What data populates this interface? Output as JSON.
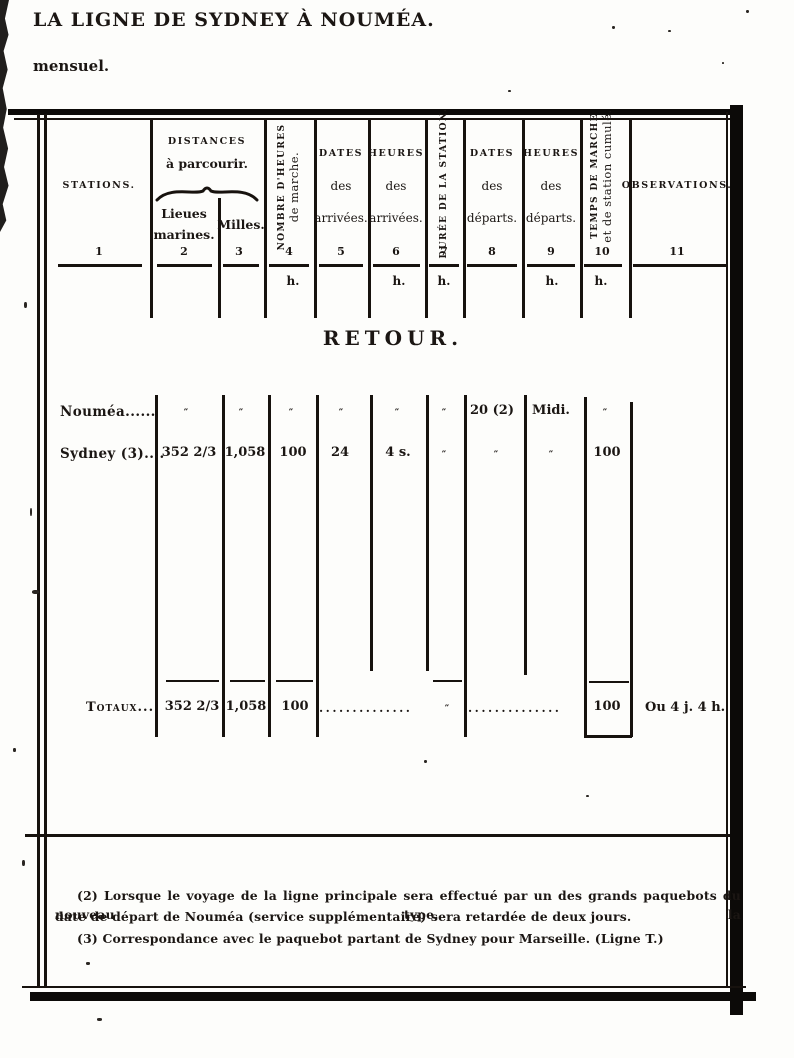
{
  "page": {
    "title": "LA LIGNE DE SYDNEY À NOUMÉA.",
    "subtitle": "mensuel."
  },
  "table": {
    "header": {
      "stations": {
        "label": "STATIONS.",
        "num": "1"
      },
      "distances_group": {
        "line1": "DISTANCES",
        "line2": "à parcourir."
      },
      "lieues": {
        "line1": "Lieues",
        "line2": "marines.",
        "num": "2"
      },
      "milles": {
        "label": "Milles.",
        "num": "3"
      },
      "heures_marche": {
        "line1": "NOMBRE D'HEURES",
        "line2": "de marche.",
        "num": "4",
        "unit": "h."
      },
      "dates_arrivees": {
        "line1": "DATES",
        "line2": "des",
        "line3": "arrivées.",
        "num": "5"
      },
      "heures_arrivees": {
        "line1": "HEURES",
        "line2": "des",
        "line3": "arrivées.",
        "num": "6",
        "unit": "h."
      },
      "duree_station": {
        "label": "DURÉE DE LA STATION.",
        "num": "7",
        "unit": "h."
      },
      "dates_departs": {
        "line1": "DATES",
        "line2": "des",
        "line3": "départs.",
        "num": "8"
      },
      "heures_departs": {
        "line1": "HEURES",
        "line2": "des",
        "line3": "départs.",
        "num": "9",
        "unit": "h."
      },
      "temps_marche": {
        "line1": "TEMPS DE MARCHE",
        "line2": "et de station cumulé.",
        "num": "10",
        "unit": "h."
      },
      "observations": {
        "label": "OBSERVATIONS.",
        "num": "11"
      }
    },
    "section_title": "RETOUR.",
    "rows": [
      {
        "station": "Nouméa......",
        "lieues": "″",
        "milles": "″",
        "heures_marche": "″",
        "dates_arr": "″",
        "heures_arr": "″",
        "duree": "″",
        "dates_dep": "20 (2)",
        "heures_dep": "Midi.",
        "temps": "″"
      },
      {
        "station": "Sydney (3)....",
        "lieues": "352 2/3",
        "milles": "1,058",
        "heures_marche": "100",
        "dates_arr": "24",
        "heures_arr": "4 s.",
        "duree": "″",
        "dates_dep": "″",
        "heures_dep": "″",
        "temps": "100"
      }
    ],
    "totals": {
      "label": "Totaux...",
      "lieues": "352 2/3",
      "milles": "1,058",
      "heures_marche": "100",
      "leader1": "..............",
      "duree": "″",
      "leader2": "..............",
      "temps": "100",
      "obs": "Ou 4 j. 4 h."
    }
  },
  "footnotes": {
    "note2_line1": "(2) Lorsque le voyage de la ligne principale sera effectué par un des grands paquebots du nouveau type, la",
    "note2_line2": "date de départ de Nouméa (service supplémentaire) sera retardée de deux jours.",
    "note3": "(3) Correspondance avec le paquebot partant de Sydney pour Marseille. (Ligne T.)"
  }
}
